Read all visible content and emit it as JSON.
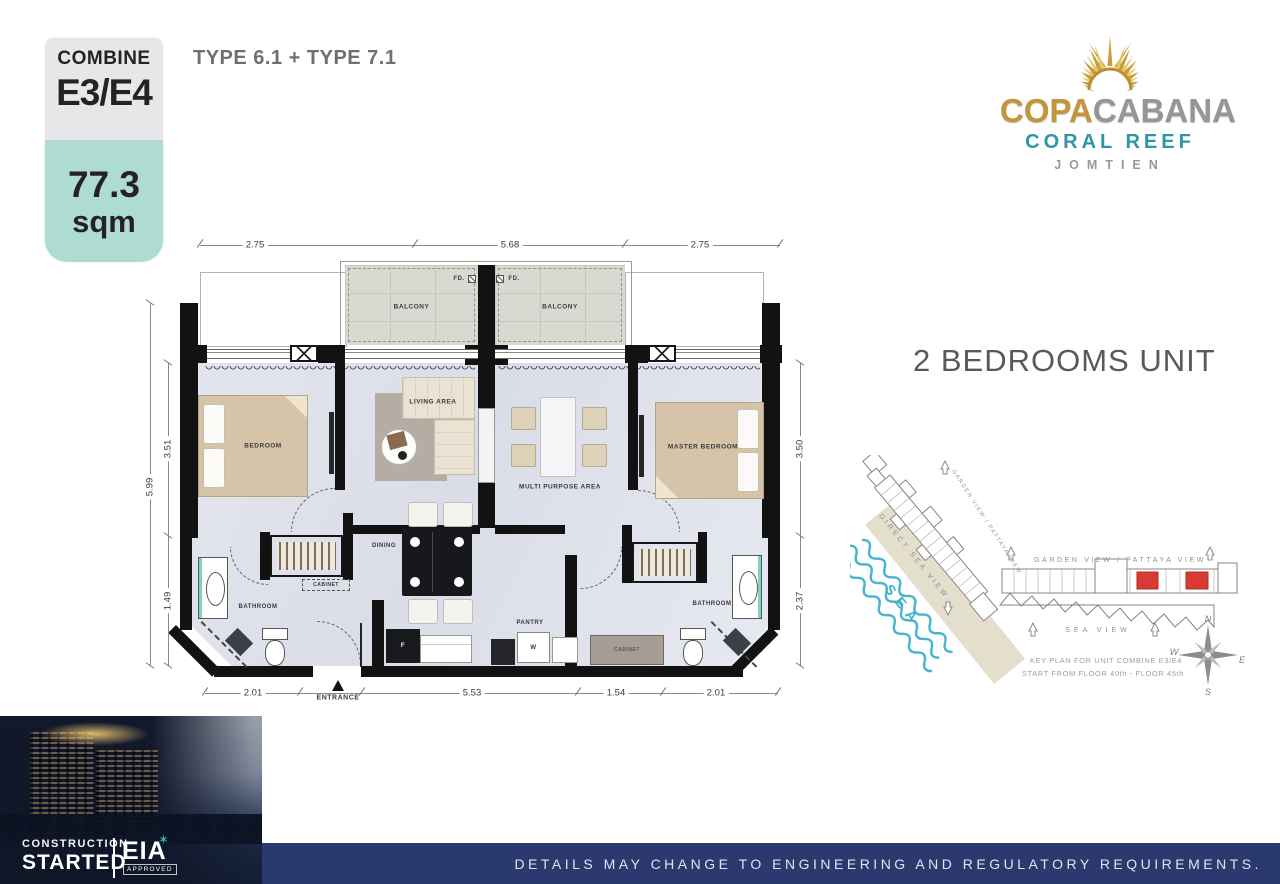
{
  "badge": {
    "combine_label": "COMBINE",
    "unit_code": "E3/E4",
    "area_value": "77.3",
    "area_unit": "sqm"
  },
  "header": {
    "type_combo": "TYPE 6.1 + TYPE 7.1"
  },
  "logo": {
    "name_gold": "COPA",
    "name_silver": "CABANA",
    "subtitle": "CORAL REEF",
    "location": "JOMTIEN"
  },
  "unit_title": "2 BEDROOMS UNIT",
  "floorplan": {
    "room_labels": {
      "balcony_left": "BALCONY",
      "balcony_right": "BALCONY",
      "fd_left": "FD.",
      "fd_right": "FD.",
      "bedroom": "BEDROOM",
      "living_area": "LIVING AREA",
      "master_bedroom": "MASTER BEDROOM",
      "multi_purpose": "MULTI PURPOSE AREA",
      "dining": "DINING",
      "bathroom_left": "BATHROOM",
      "bathroom_right": "BATHROOM",
      "pantry": "PANTRY",
      "cabinet_left": "CABINET",
      "cabinet_right": "CABINET",
      "entrance": "ENTRANCE",
      "washer": "W",
      "fridge": "F"
    },
    "dimensions": {
      "top": [
        "2.75",
        "5.68",
        "2.75"
      ],
      "bottom": [
        "2.01",
        "5.53",
        "1.54",
        "2.01"
      ],
      "left_upper": "3.51",
      "left_lower": "1.49",
      "left_overall": "5.99",
      "right_upper": "3.50",
      "right_lower": "2.37"
    }
  },
  "keyplan": {
    "garden_view_diagonal": "GARDEN VIEW / PATTAYA VIEW",
    "garden_view_horizontal": "GARDEN VIEW / PATTAYA VIEW",
    "direct_sea_view": "DIRECT SEA VIEW",
    "sea": "SEA",
    "sea_view": "SEA VIEW",
    "caption_line1": "KEY PLAN FOR UNIT COMBINE E3/E4",
    "caption_line2": "START FROM FLOOR 40th - FLOOR 45th",
    "compass": {
      "north": "N",
      "east": "E",
      "south": "S",
      "west": "W"
    }
  },
  "footer": {
    "construction_line1": "CONSTRUCTION",
    "construction_line2": "STARTED",
    "eia": "EIA",
    "approved": "APPROVED",
    "disclaimer": "DETAILS MAY CHANGE TO ENGINEERING AND REGULATORY REQUIREMENTS."
  },
  "colors": {
    "accent_teal": "#aedbd2",
    "brand_gold": "#c49539",
    "brand_silver": "#95959a",
    "coral_teal": "#2e97a3",
    "footer_navy": "#2b3a6e",
    "sea_wave": "#45b6cd",
    "highlight_red": "#d93a31"
  }
}
